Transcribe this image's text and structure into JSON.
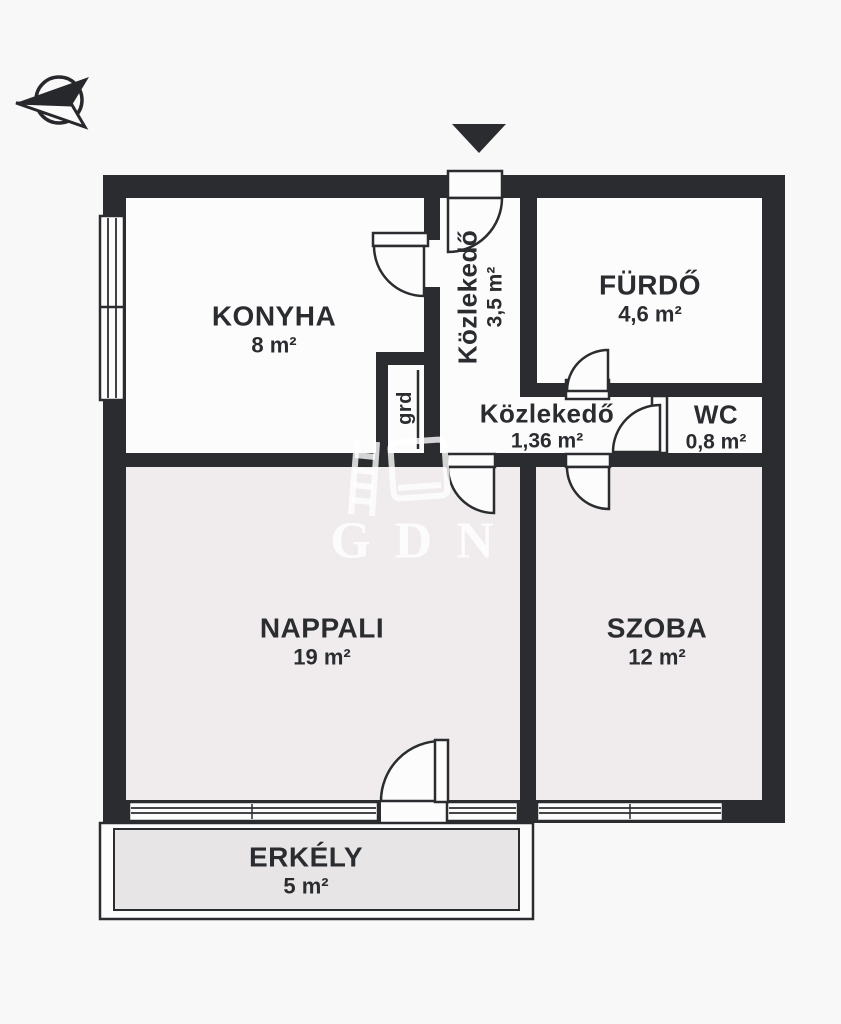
{
  "watermark": {
    "text": "GDN",
    "logo_icon": "watermark-logo-icon"
  },
  "compass": {
    "icon": "compass-arrow-icon"
  },
  "entrance": {
    "icon": "entrance-arrow-icon"
  },
  "rooms": [
    {
      "id": "konyha",
      "name": "KONYHA",
      "area": "8 m²"
    },
    {
      "id": "kozlekedo-fuggoleges",
      "name": "Közlekedő",
      "area": "3,5 m²"
    },
    {
      "id": "furdo",
      "name": "FÜRDŐ",
      "area": "4,6 m²"
    },
    {
      "id": "kozlekedo-vizszintes",
      "name": "Közlekedő",
      "area": "1,36 m²"
    },
    {
      "id": "wc",
      "name": "WC",
      "area": "0,8 m²"
    },
    {
      "id": "gardrob",
      "name": "grd"
    },
    {
      "id": "nappali",
      "name": "NAPPALI",
      "area": "19 m²"
    },
    {
      "id": "szoba",
      "name": "SZOBA",
      "area": "12 m²"
    },
    {
      "id": "erkely",
      "name": "ERKÉLY",
      "area": "5 m²"
    }
  ],
  "colors": {
    "wall": "#2a2c2f",
    "room_white": "#fcfcfc",
    "room_tinted": "#f0eced",
    "balcony_fill": "#e8e5e7",
    "background": "#f9f8f8",
    "watermark": "rgba(255,255,255,0.85)"
  }
}
